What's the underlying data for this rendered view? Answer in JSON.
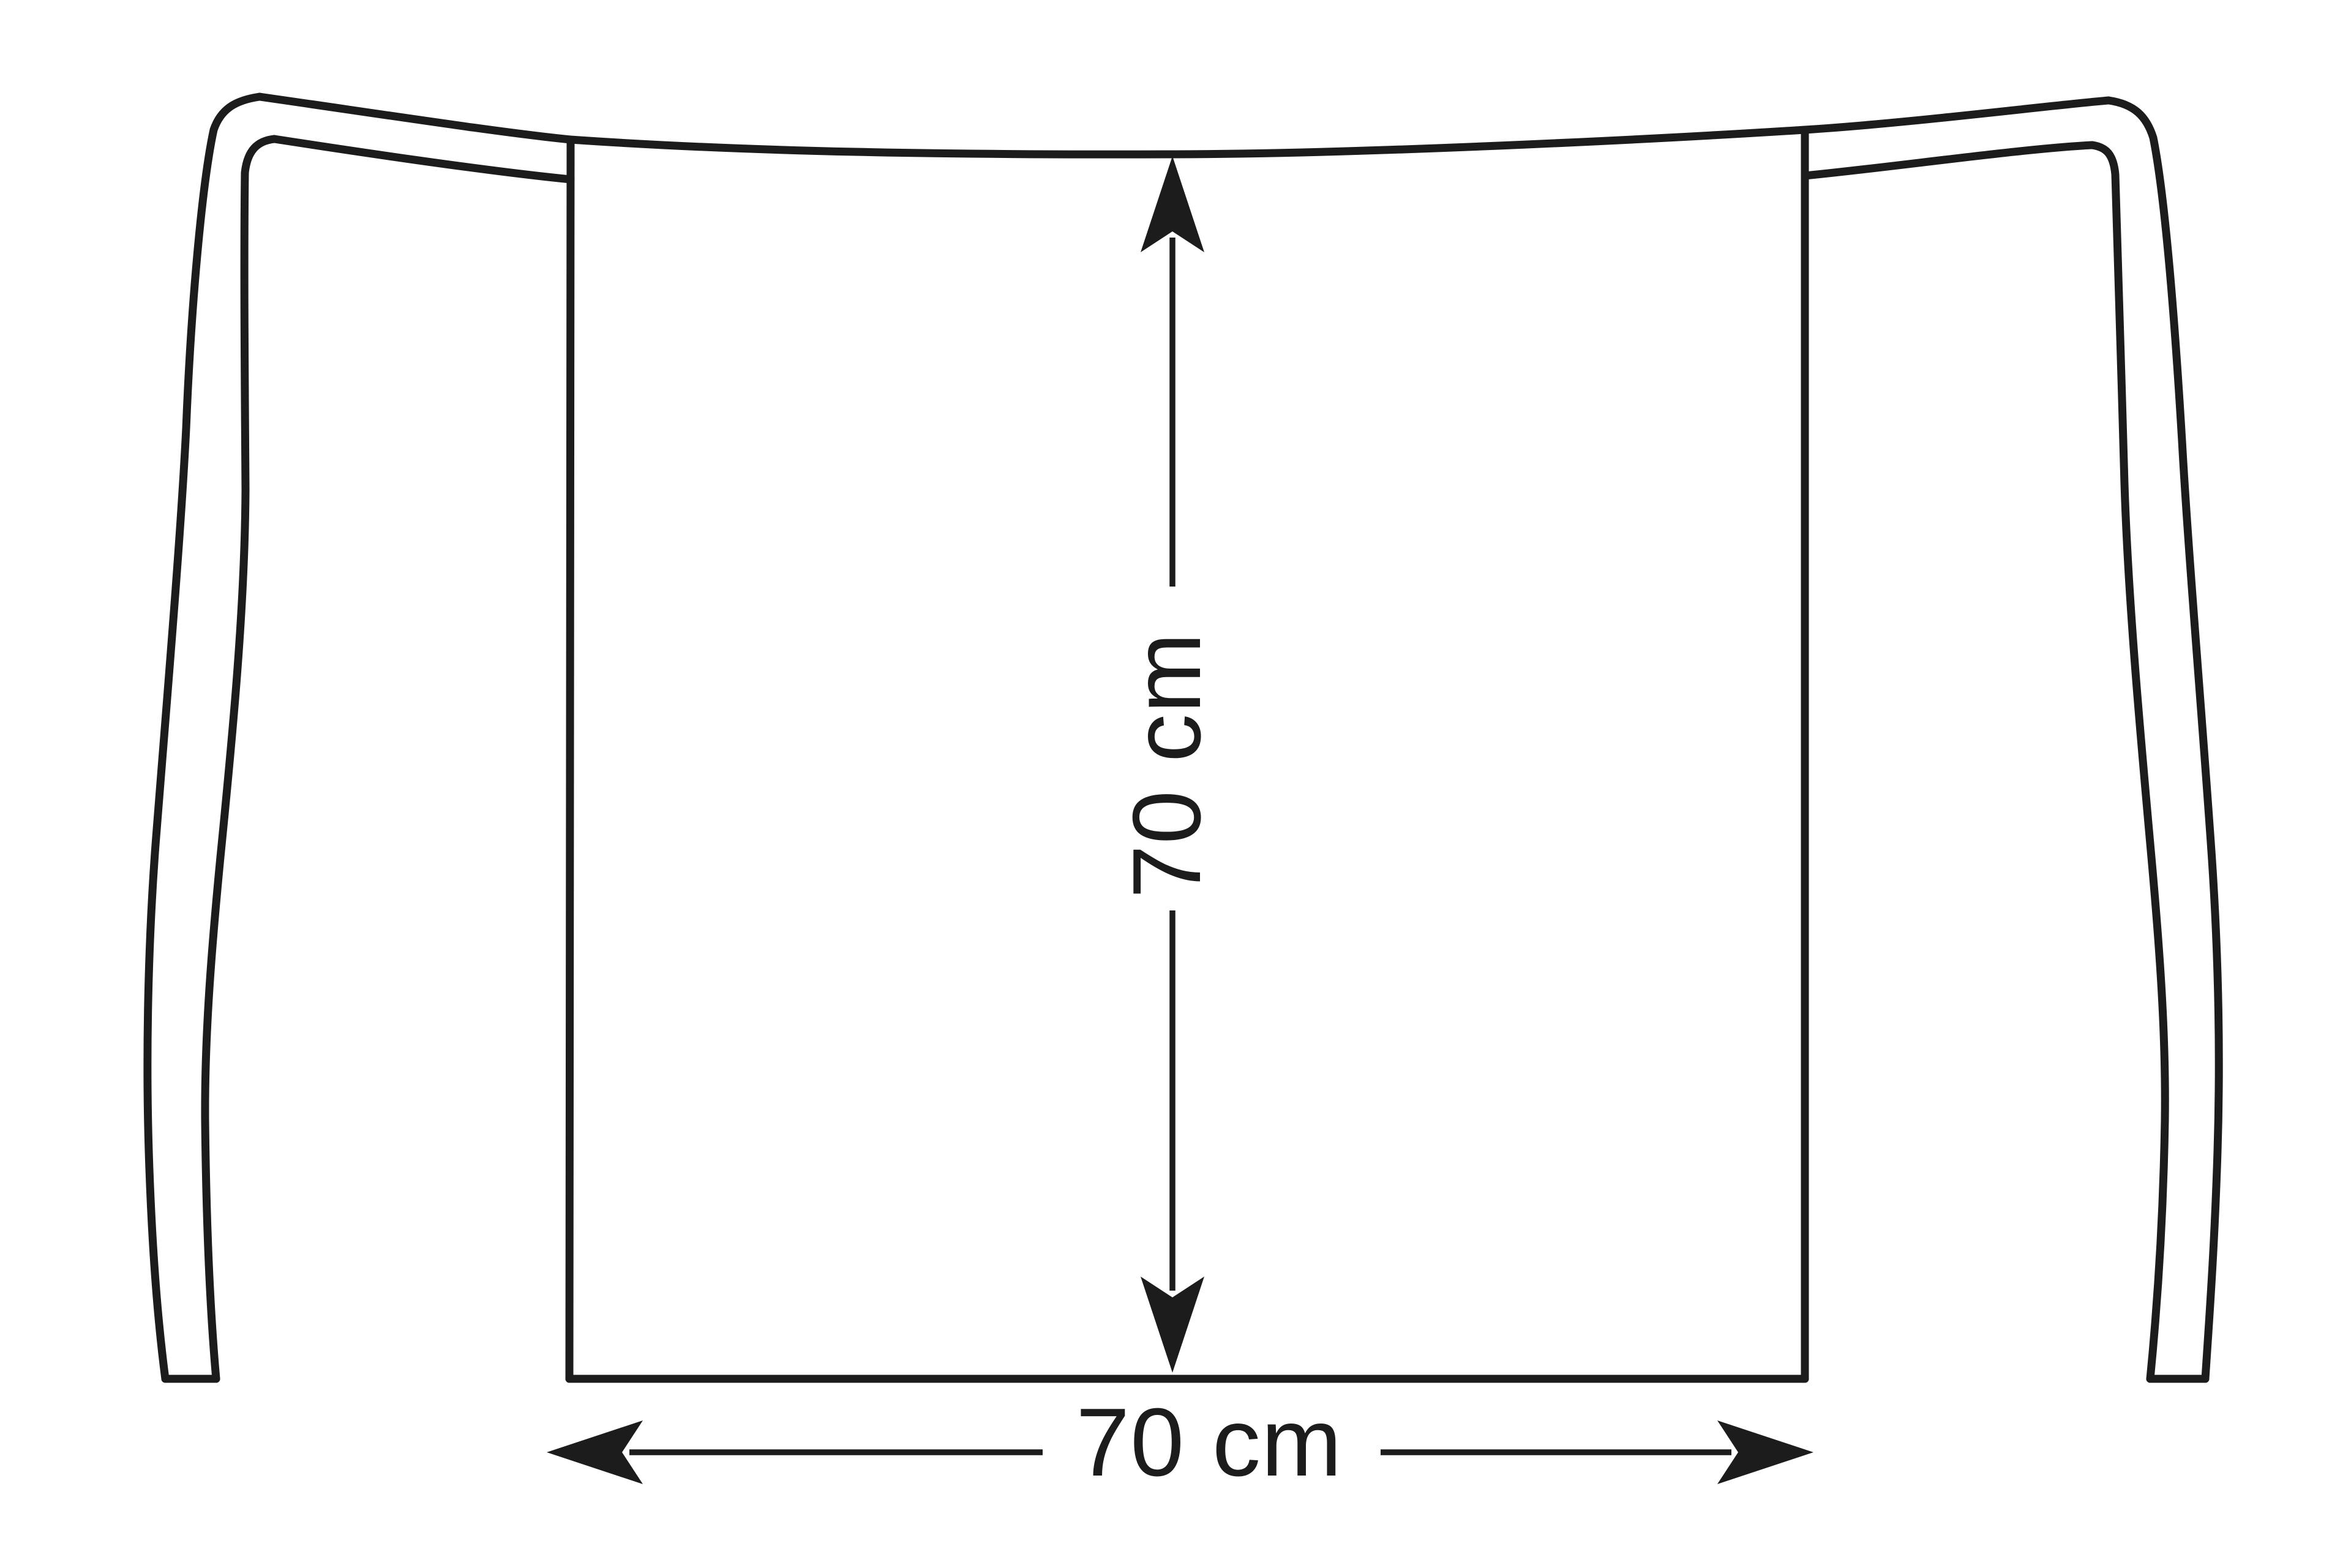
{
  "diagram": {
    "type": "technical-line-drawing",
    "subject": "waist-apron-with-ties",
    "background_color": "#ffffff",
    "line_color": "#1c1c1c",
    "height_dimension": {
      "label": "70 cm",
      "value": 70,
      "unit": "cm",
      "orientation": "vertical"
    },
    "width_dimension": {
      "label": "70 cm",
      "value": 70,
      "unit": "cm",
      "orientation": "horizontal"
    }
  }
}
